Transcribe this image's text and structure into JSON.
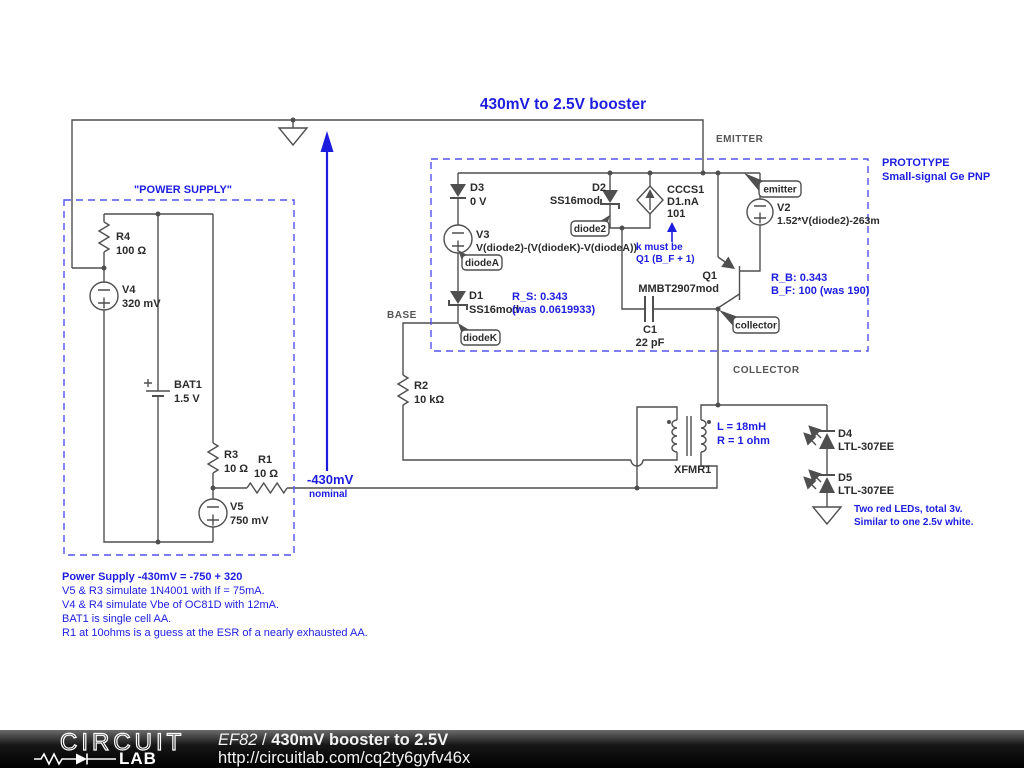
{
  "title": "430mV to 2.5V booster",
  "colors": {
    "annotation_blue": "#1d1de0",
    "wire_gray": "#4f4f4f"
  },
  "net_labels": {
    "emitter": "EMITTER",
    "base": "BASE",
    "collector": "COLLECTOR"
  },
  "node_annotation": {
    "value": "-430mV",
    "qualifier": "nominal"
  },
  "power_supply": {
    "box_label": "\"POWER SUPPLY\"",
    "r4": {
      "name": "R4",
      "value": "100 Ω"
    },
    "v4": {
      "name": "V4",
      "value": "320 mV"
    },
    "bat1": {
      "name": "BAT1",
      "value": "1.5 V"
    },
    "r3": {
      "name": "R3",
      "value": "10 Ω"
    },
    "r1": {
      "name": "R1",
      "value": "10 Ω"
    },
    "v5": {
      "name": "V5",
      "value": "750 mV"
    }
  },
  "prototype": {
    "label1": "PROTOTYPE",
    "label2": "Small-signal Ge PNP",
    "d3": {
      "name": "D3",
      "value": "0 V"
    },
    "v3": {
      "name": "V3",
      "value": "V(diode2)-(V(diodeK)-V(diodeA))"
    },
    "d1": {
      "name": "D1",
      "value": "SS16mod",
      "note1": "R_S: 0.343",
      "note2": "(was 0.0619933)"
    },
    "d2": {
      "name": "D2",
      "value": "SS16mod"
    },
    "cccs1": {
      "name": "CCCS1",
      "value": "D1.nA",
      "gain": "101",
      "note1": "k must be",
      "note2": "Q1 (B_F + 1)"
    },
    "q1": {
      "name": "Q1",
      "value": "MMBT2907mod",
      "note1": "R_B: 0.343",
      "note2": "B_F: 100 (was 190)"
    },
    "v2": {
      "name": "V2",
      "value": "1.52*V(diode2)-263m"
    },
    "c1": {
      "name": "C1",
      "value": "22 pF"
    },
    "tags": {
      "diodeA": "diodeA",
      "diodeK": "diodeK",
      "diode2": "diode2",
      "emitter": "emitter",
      "collector": "collector"
    }
  },
  "r2": {
    "name": "R2",
    "value": "10 kΩ"
  },
  "xfmr1": {
    "name": "XFMR1",
    "note1": "L = 18mH",
    "note2": "R = 1 ohm"
  },
  "leds": {
    "d4": {
      "name": "D4",
      "value": "LTL-307EE"
    },
    "d5": {
      "name": "D5",
      "value": "LTL-307EE"
    },
    "note1": "Two red LEDs, total 3v.",
    "note2": "Similar to one 2.5v white."
  },
  "notes": {
    "heading": "Power Supply -430mV = -750 + 320",
    "line1": "V5 & R3 simulate 1N4001 with If = 75mA.",
    "line2": "V4 & R4 simulate Vbe of OC81D with 12mA.",
    "line3": "BAT1 is single cell AA.",
    "line4": "R1 at 10ohms is a guess at the ESR of a nearly exhausted AA."
  },
  "footer": {
    "logo_top": "CIRCUIT",
    "logo_bottom": "LAB",
    "doc_author": "EF82",
    "separator": "/",
    "doc_title": "430mV booster to 2.5V",
    "url": "http://circuitlab.com/cq2ty6gyfv46x"
  }
}
